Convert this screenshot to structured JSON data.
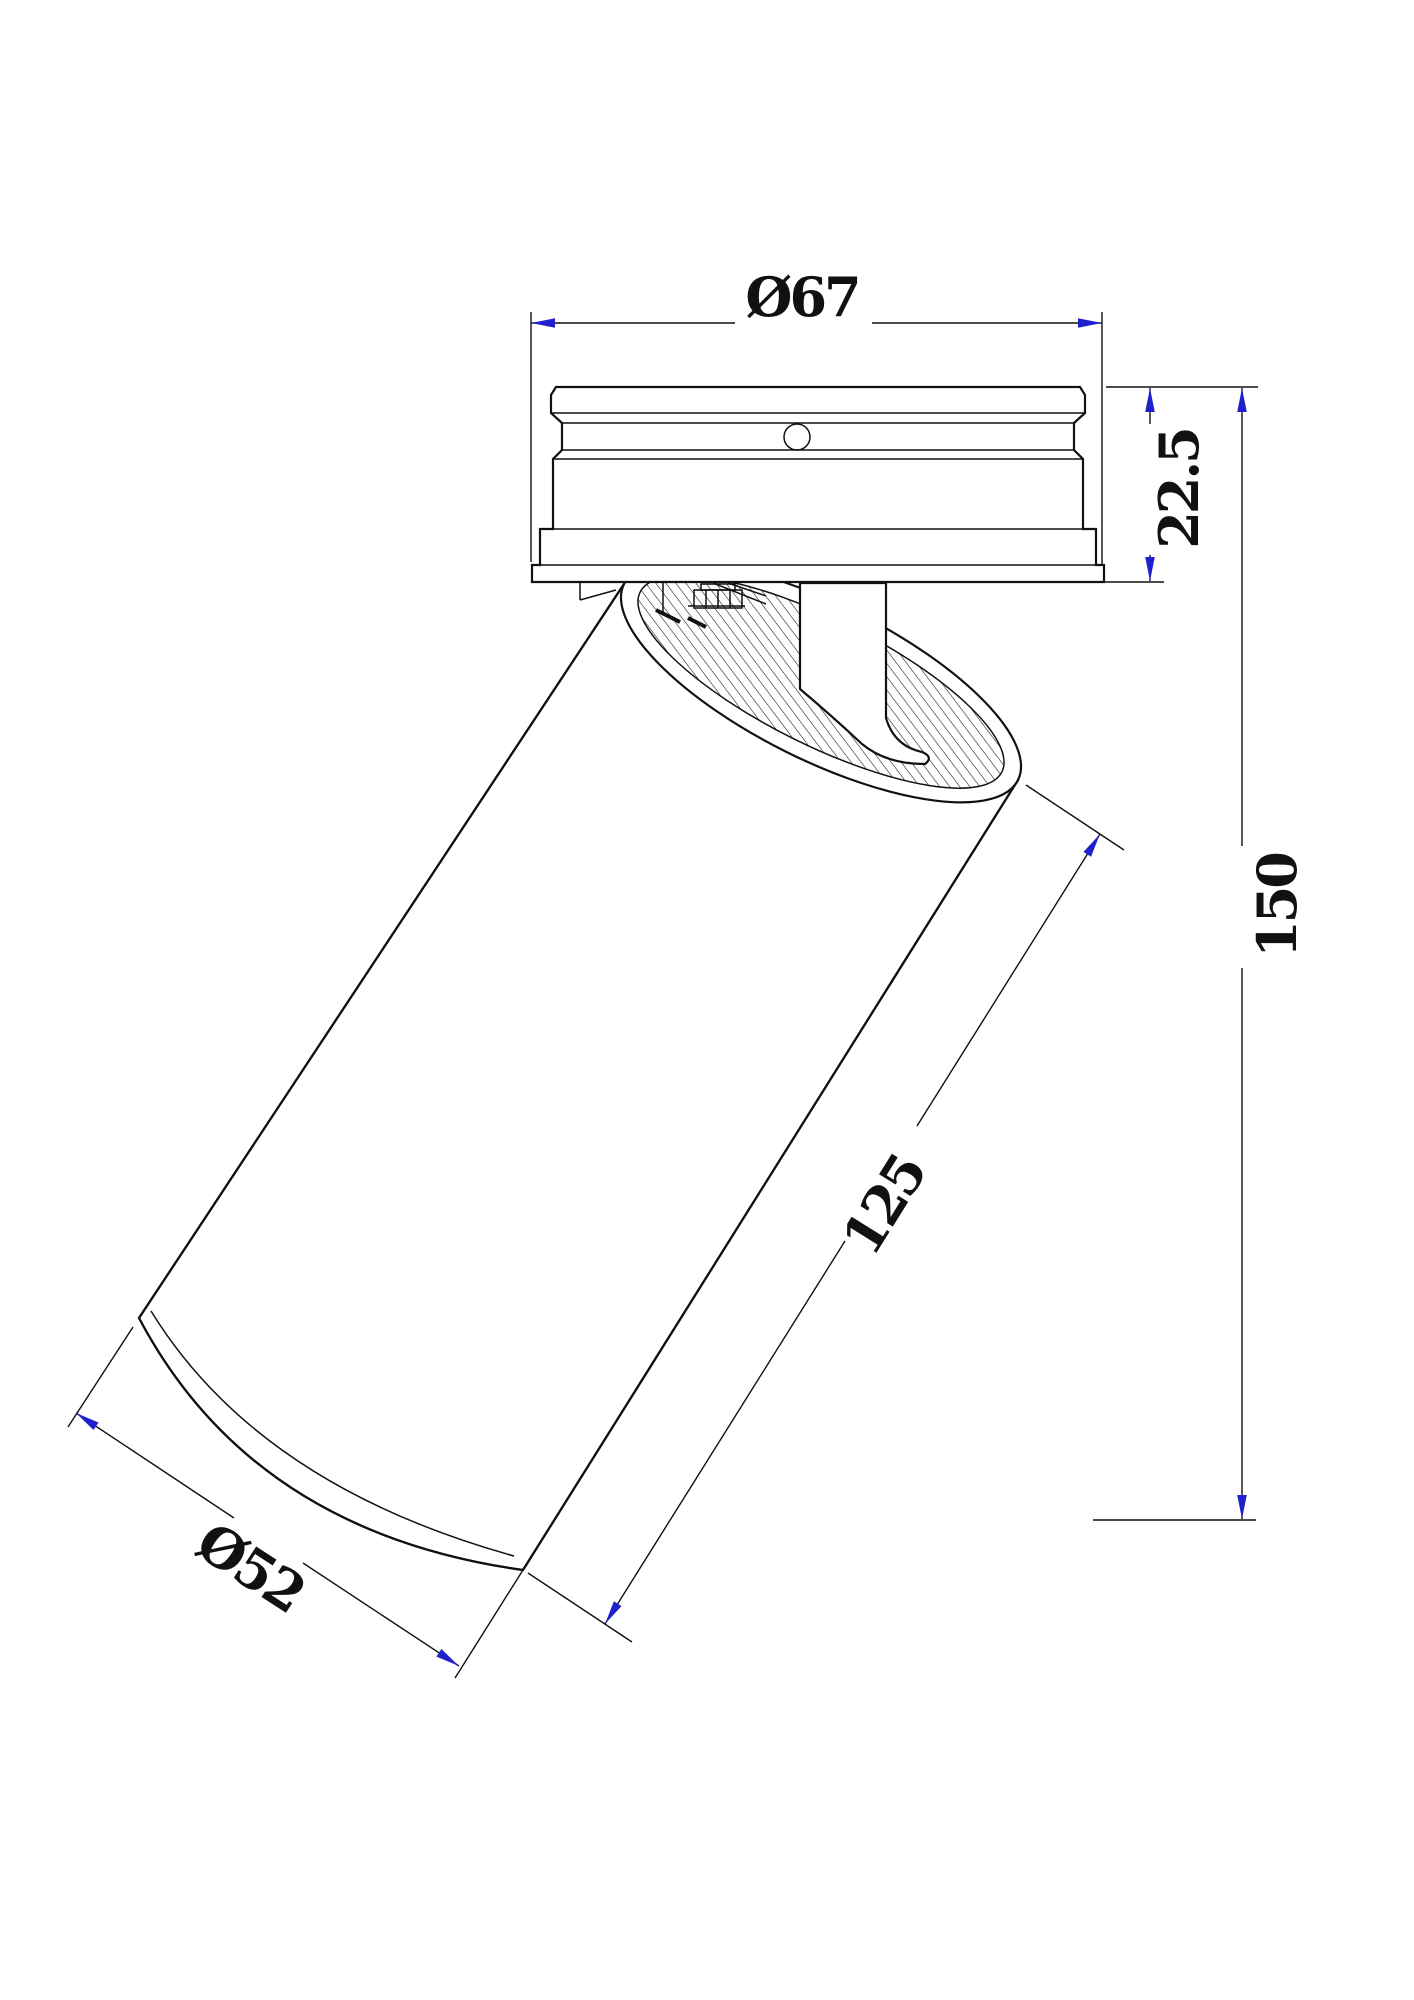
{
  "drawing": {
    "dimensions": {
      "canopy_diameter": {
        "label": "Ø67"
      },
      "canopy_height": {
        "label": "22.5"
      },
      "overall_height": {
        "label": "150"
      },
      "body_length": {
        "label": "125"
      },
      "body_diameter": {
        "label": "Ø52"
      }
    },
    "colors": {
      "ink": "#111111",
      "arrow": "#2121cc",
      "paper": "#ffffff"
    }
  }
}
